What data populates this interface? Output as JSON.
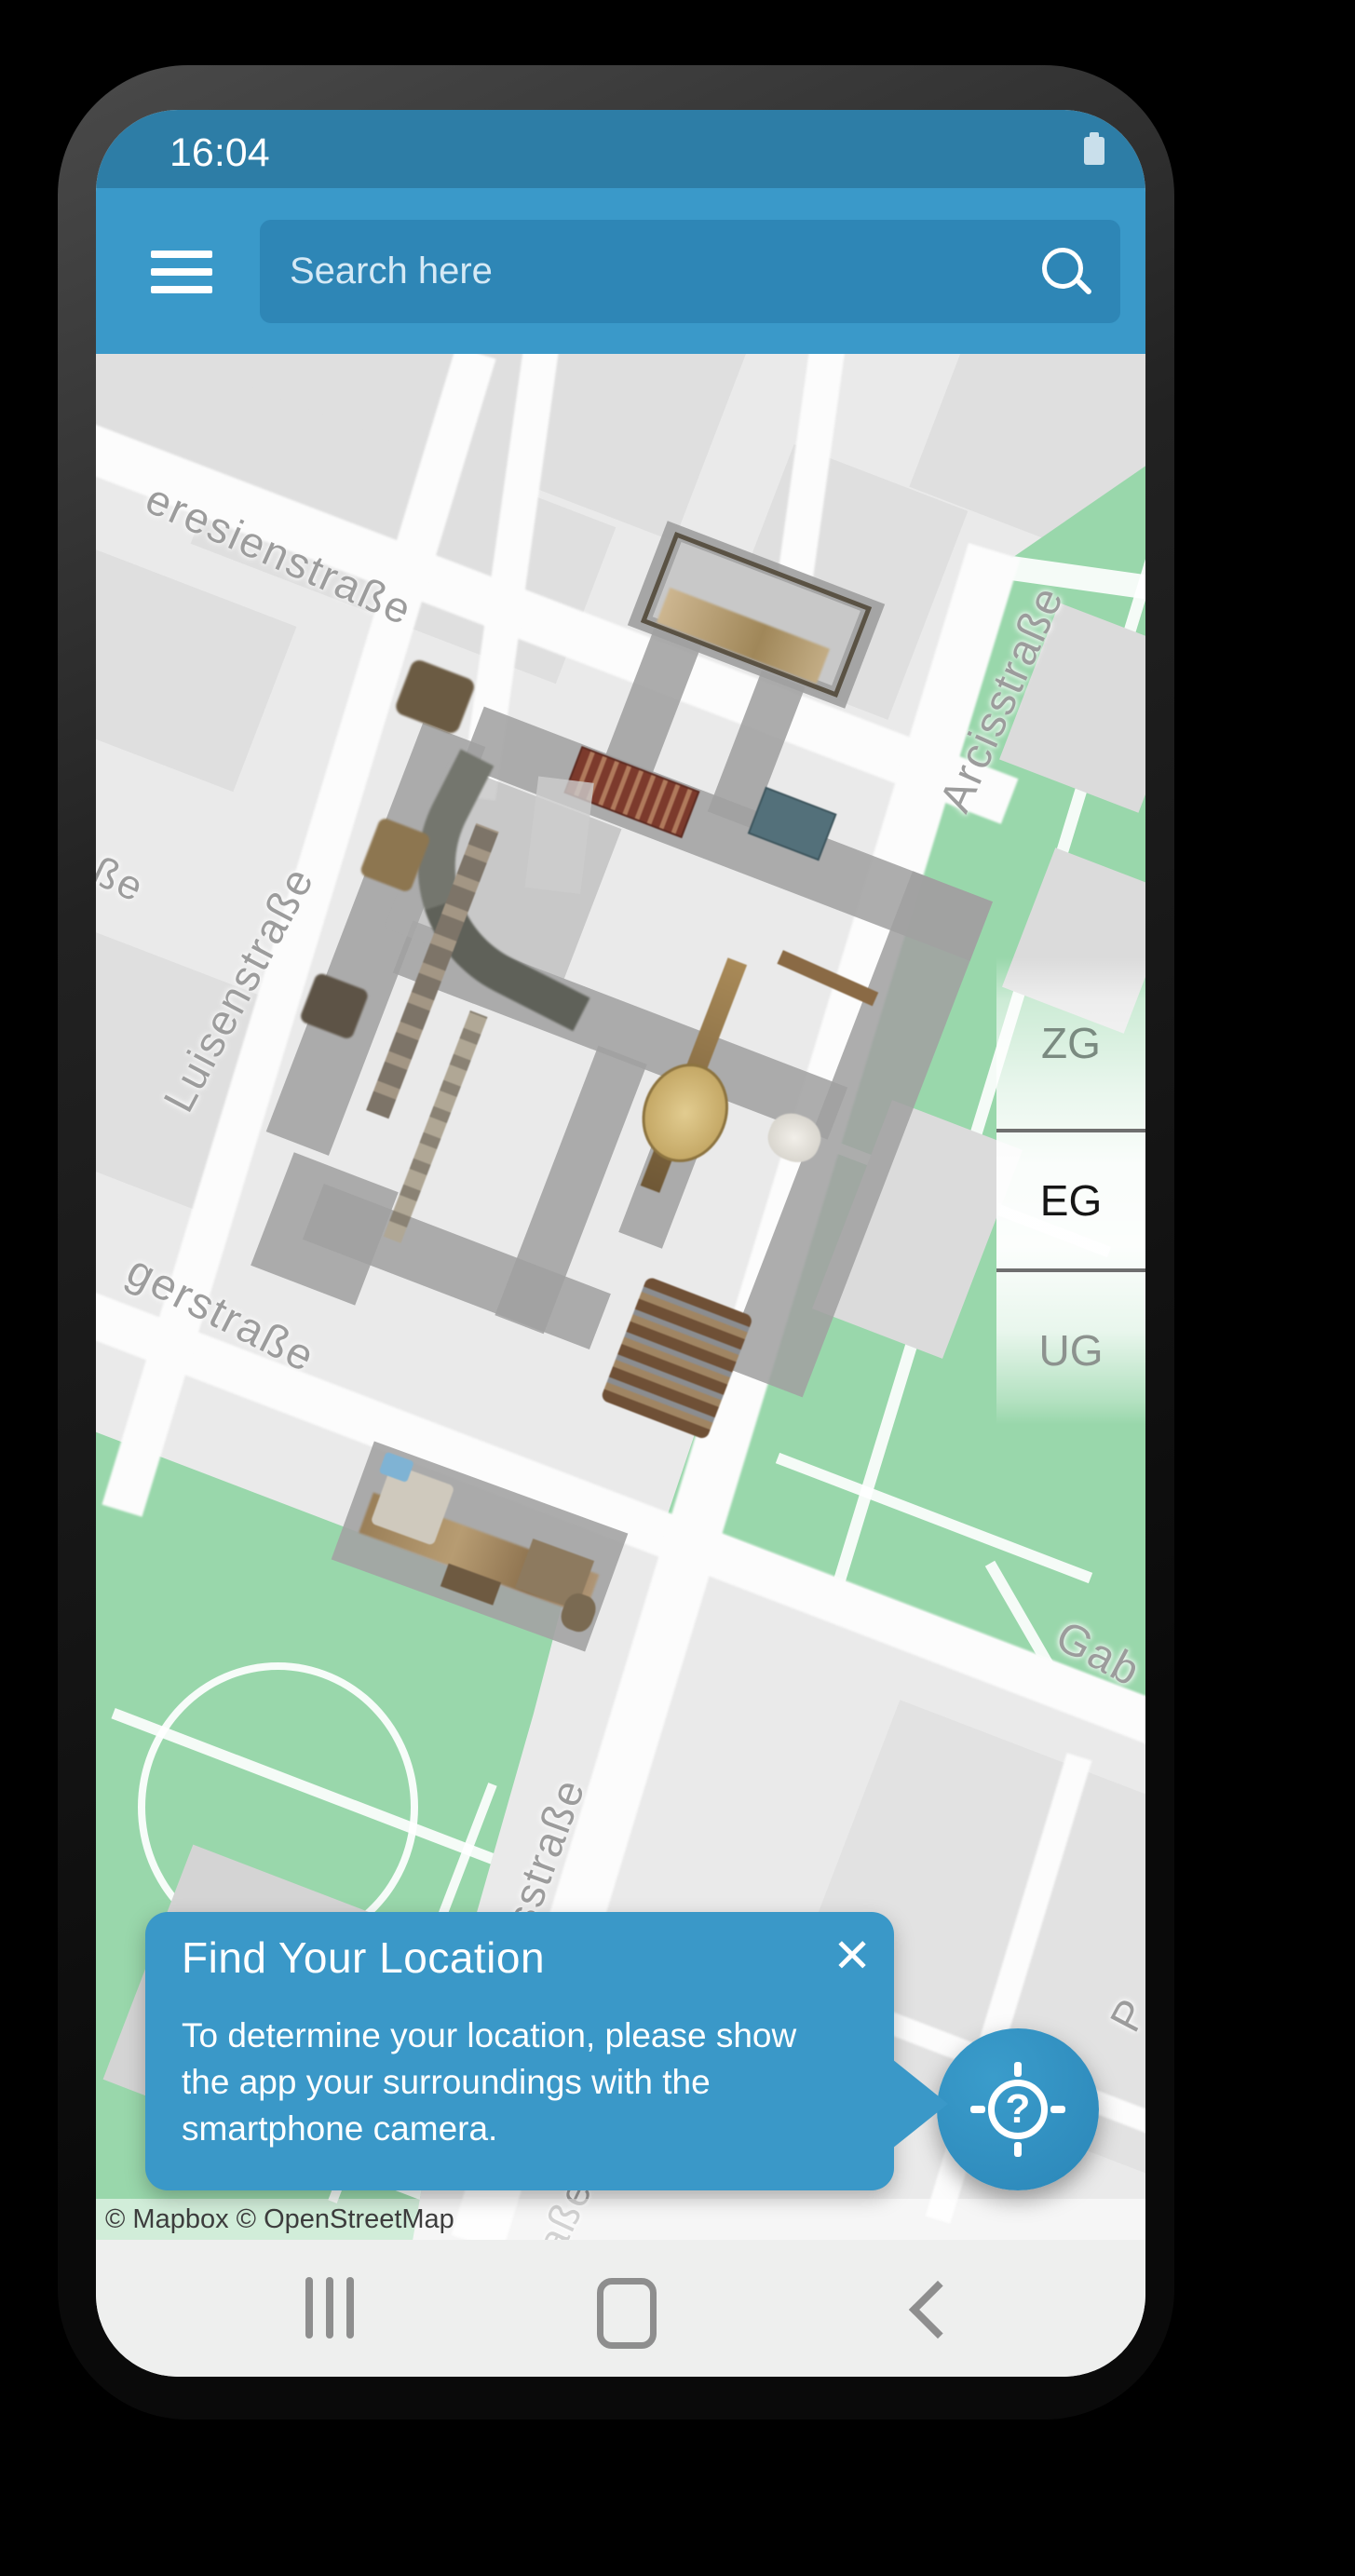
{
  "status_bar": {
    "time": "16:04",
    "battery_icon": "battery-full-icon"
  },
  "app_bar": {
    "menu_icon": "hamburger-menu-icon",
    "search": {
      "placeholder": "Search here",
      "icon": "search-icon"
    }
  },
  "map": {
    "attribution": "© Mapbox © OpenStreetMap",
    "street_labels": [
      {
        "text": "eresienstraße"
      },
      {
        "text": "Arcisstraße"
      },
      {
        "text": "Luisenstraße"
      },
      {
        "text": "gerstraße"
      },
      {
        "text": "ße"
      },
      {
        "text": "sstraße"
      },
      {
        "text": "aße"
      },
      {
        "text": "Gab"
      },
      {
        "text": "P"
      }
    ]
  },
  "floor_selector": {
    "options": [
      {
        "label": "ZG",
        "selected": false
      },
      {
        "label": "EG",
        "selected": true
      },
      {
        "label": "UG",
        "selected": false
      }
    ]
  },
  "location_popup": {
    "title": "Find Your Location",
    "body": "To determine your location, please show the app your surroundings with the smartphone camera.",
    "close_icon": "close-icon"
  },
  "fab": {
    "icon": "locate-question-icon"
  },
  "nav_bar": {
    "recents_icon": "recents-icon",
    "home_icon": "home-icon",
    "back_icon": "back-icon"
  },
  "colors": {
    "status_bar": "#2d7da6",
    "app_bar": "#3a99c9",
    "search_field": "#2e86b6",
    "popup": "#3a98c8",
    "fab": "#2e8fc0",
    "map_green": "#99d7ab",
    "map_base": "#eaeaea"
  }
}
